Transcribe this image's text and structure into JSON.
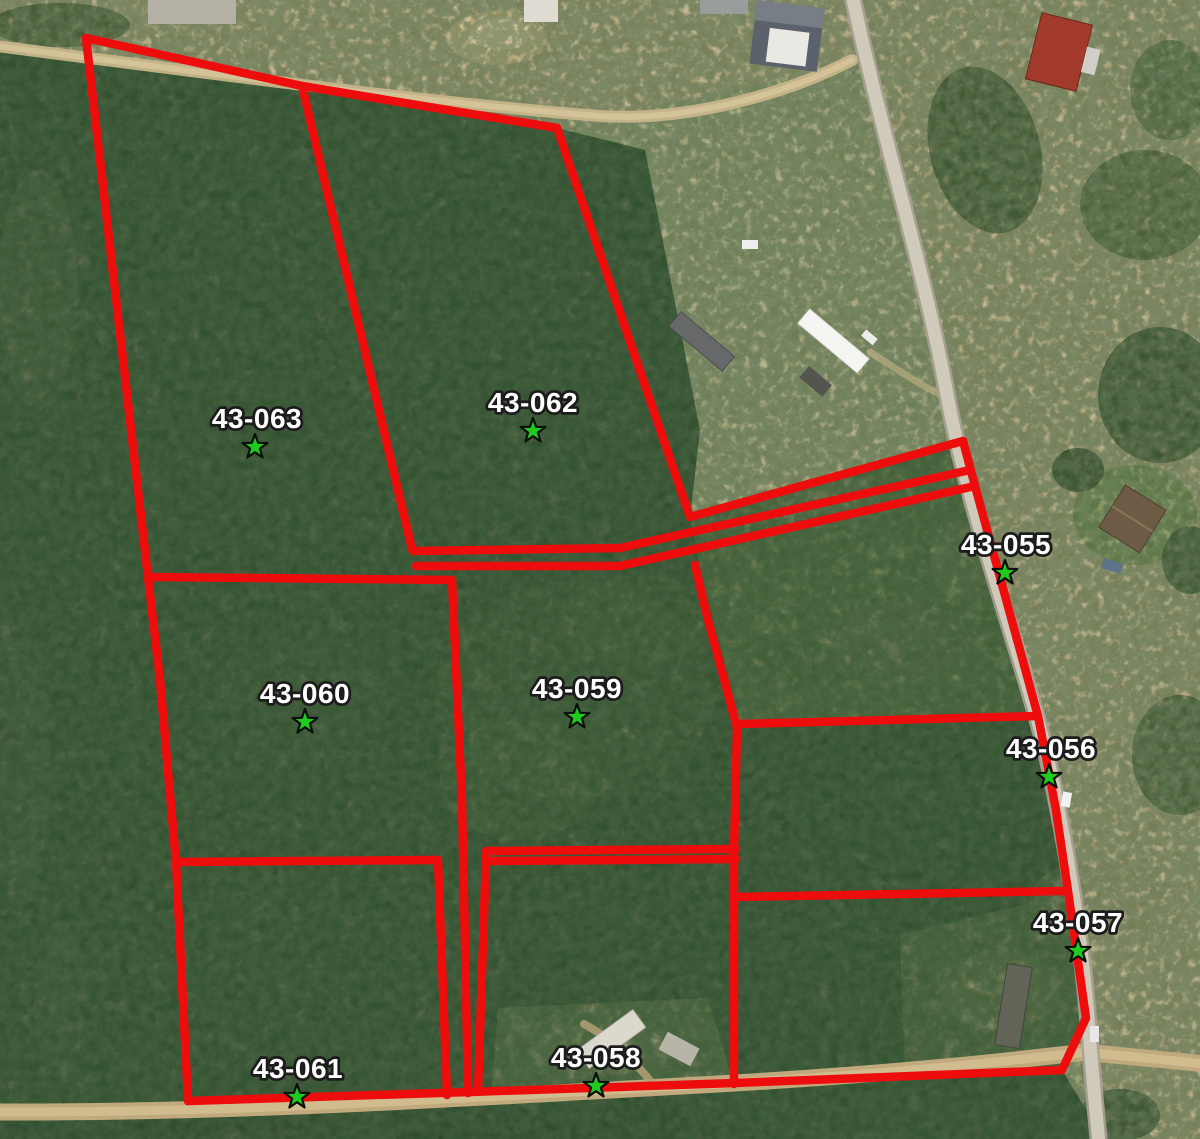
{
  "map": {
    "type": "aerial-parcel-map",
    "colors": {
      "boundary": "#ee0d0d",
      "star_fill": "#1ecb1e",
      "star_stroke": "#0d0d0d",
      "label_fill": "#fdfdfd",
      "label_stroke": "#1c1c1c"
    },
    "boundary_stroke_width": 8.5,
    "star_outer_radius": 13,
    "star_inner_radius": 5.2,
    "parcels": [
      {
        "id": "43-063",
        "label_x": 257,
        "label_y": 428,
        "star_x": 255,
        "star_y": 447
      },
      {
        "id": "43-062",
        "label_x": 533,
        "label_y": 412,
        "star_x": 533,
        "star_y": 431
      },
      {
        "id": "43-055",
        "label_x": 1006,
        "label_y": 554,
        "star_x": 1005,
        "star_y": 573
      },
      {
        "id": "43-060",
        "label_x": 305,
        "label_y": 703,
        "star_x": 305,
        "star_y": 722
      },
      {
        "id": "43-059",
        "label_x": 577,
        "label_y": 698,
        "star_x": 577,
        "star_y": 717
      },
      {
        "id": "43-056",
        "label_x": 1051,
        "label_y": 758,
        "star_x": 1049,
        "star_y": 777
      },
      {
        "id": "43-057",
        "label_x": 1078,
        "label_y": 932,
        "star_x": 1078,
        "star_y": 951
      },
      {
        "id": "43-061",
        "label_x": 298,
        "label_y": 1078,
        "star_x": 297,
        "star_y": 1097
      },
      {
        "id": "43-058",
        "label_x": 596,
        "label_y": 1067,
        "star_x": 596,
        "star_y": 1086
      }
    ],
    "boundaries": [
      {
        "name": "outer-west",
        "points": [
          [
            86,
            38
          ],
          [
            148,
            577
          ],
          [
            160,
            680
          ],
          [
            176,
            862
          ],
          [
            188,
            1101
          ]
        ]
      },
      {
        "name": "outer-north",
        "points": [
          [
            86,
            38
          ],
          [
            302,
            86
          ],
          [
            557,
            128
          ]
        ]
      },
      {
        "name": "divider-63-62",
        "points": [
          [
            302,
            86
          ],
          [
            412,
            549
          ]
        ]
      },
      {
        "name": "62-east-strip-top",
        "points": [
          [
            557,
            128
          ],
          [
            690,
            517
          ],
          [
            963,
            441
          ]
        ]
      },
      {
        "name": "strip-upper",
        "points": [
          [
            413,
            551
          ],
          [
            620,
            548
          ],
          [
            970,
            470
          ]
        ]
      },
      {
        "name": "strip-lower",
        "points": [
          [
            416,
            566
          ],
          [
            620,
            566
          ],
          [
            975,
            486
          ]
        ]
      },
      {
        "name": "60-north",
        "points": [
          [
            148,
            577
          ],
          [
            452,
            580
          ]
        ]
      },
      {
        "name": "mid-vertical",
        "points": [
          [
            452,
            580
          ],
          [
            462,
            800
          ],
          [
            468,
            1093
          ]
        ]
      },
      {
        "name": "strip2-east",
        "points": [
          [
            486,
            856
          ],
          [
            478,
            1090
          ]
        ]
      },
      {
        "name": "61-north-east",
        "points": [
          [
            176,
            862
          ],
          [
            438,
            860
          ],
          [
            447,
            1095
          ]
        ]
      },
      {
        "name": "58-north-a",
        "points": [
          [
            486,
            851
          ],
          [
            736,
            849
          ]
        ]
      },
      {
        "name": "58-north-b",
        "points": [
          [
            490,
            861
          ],
          [
            736,
            859
          ]
        ]
      },
      {
        "name": "58-east",
        "points": [
          [
            737,
            727
          ],
          [
            734,
            852
          ],
          [
            734,
            1084
          ]
        ]
      },
      {
        "name": "59-east",
        "points": [
          [
            695,
            565
          ],
          [
            708,
            620
          ],
          [
            737,
            727
          ]
        ]
      },
      {
        "name": "56-north",
        "points": [
          [
            738,
            724
          ],
          [
            1038,
            716
          ]
        ]
      },
      {
        "name": "57-north",
        "points": [
          [
            736,
            897
          ],
          [
            1064,
            891
          ]
        ]
      },
      {
        "name": "east-road-line",
        "points": [
          [
            963,
            441
          ],
          [
            975,
            486
          ],
          [
            1038,
            716
          ],
          [
            1056,
            810
          ],
          [
            1068,
            891
          ],
          [
            1086,
            1018
          ],
          [
            1062,
            1070
          ]
        ]
      },
      {
        "name": "outer-south",
        "points": [
          [
            1062,
            1070
          ],
          [
            735,
            1083
          ],
          [
            470,
            1092
          ],
          [
            188,
            1101
          ]
        ]
      }
    ]
  }
}
